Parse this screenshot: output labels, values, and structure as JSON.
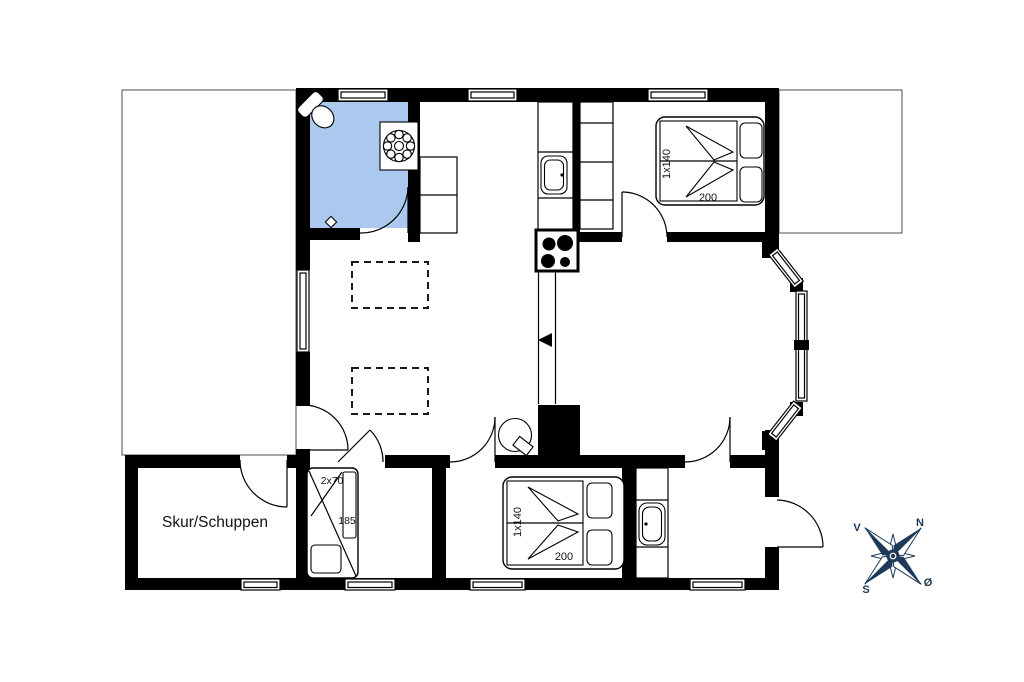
{
  "labels": {
    "shed": "Skur/Schuppen",
    "bunk_size": "2x70",
    "bunk_length": "185",
    "bed1_size": "1x140",
    "bed1_length": "200",
    "bed2_size": "1x140",
    "bed2_length": "200",
    "compass_n": "N",
    "compass_s": "S",
    "compass_v": "V",
    "compass_o": "Ø"
  },
  "colors": {
    "wall": "#000000",
    "bathroom_floor": "#abc9ee",
    "compass_navy": "#1d3a5a",
    "terrace_outline": "#6a6a6a"
  }
}
